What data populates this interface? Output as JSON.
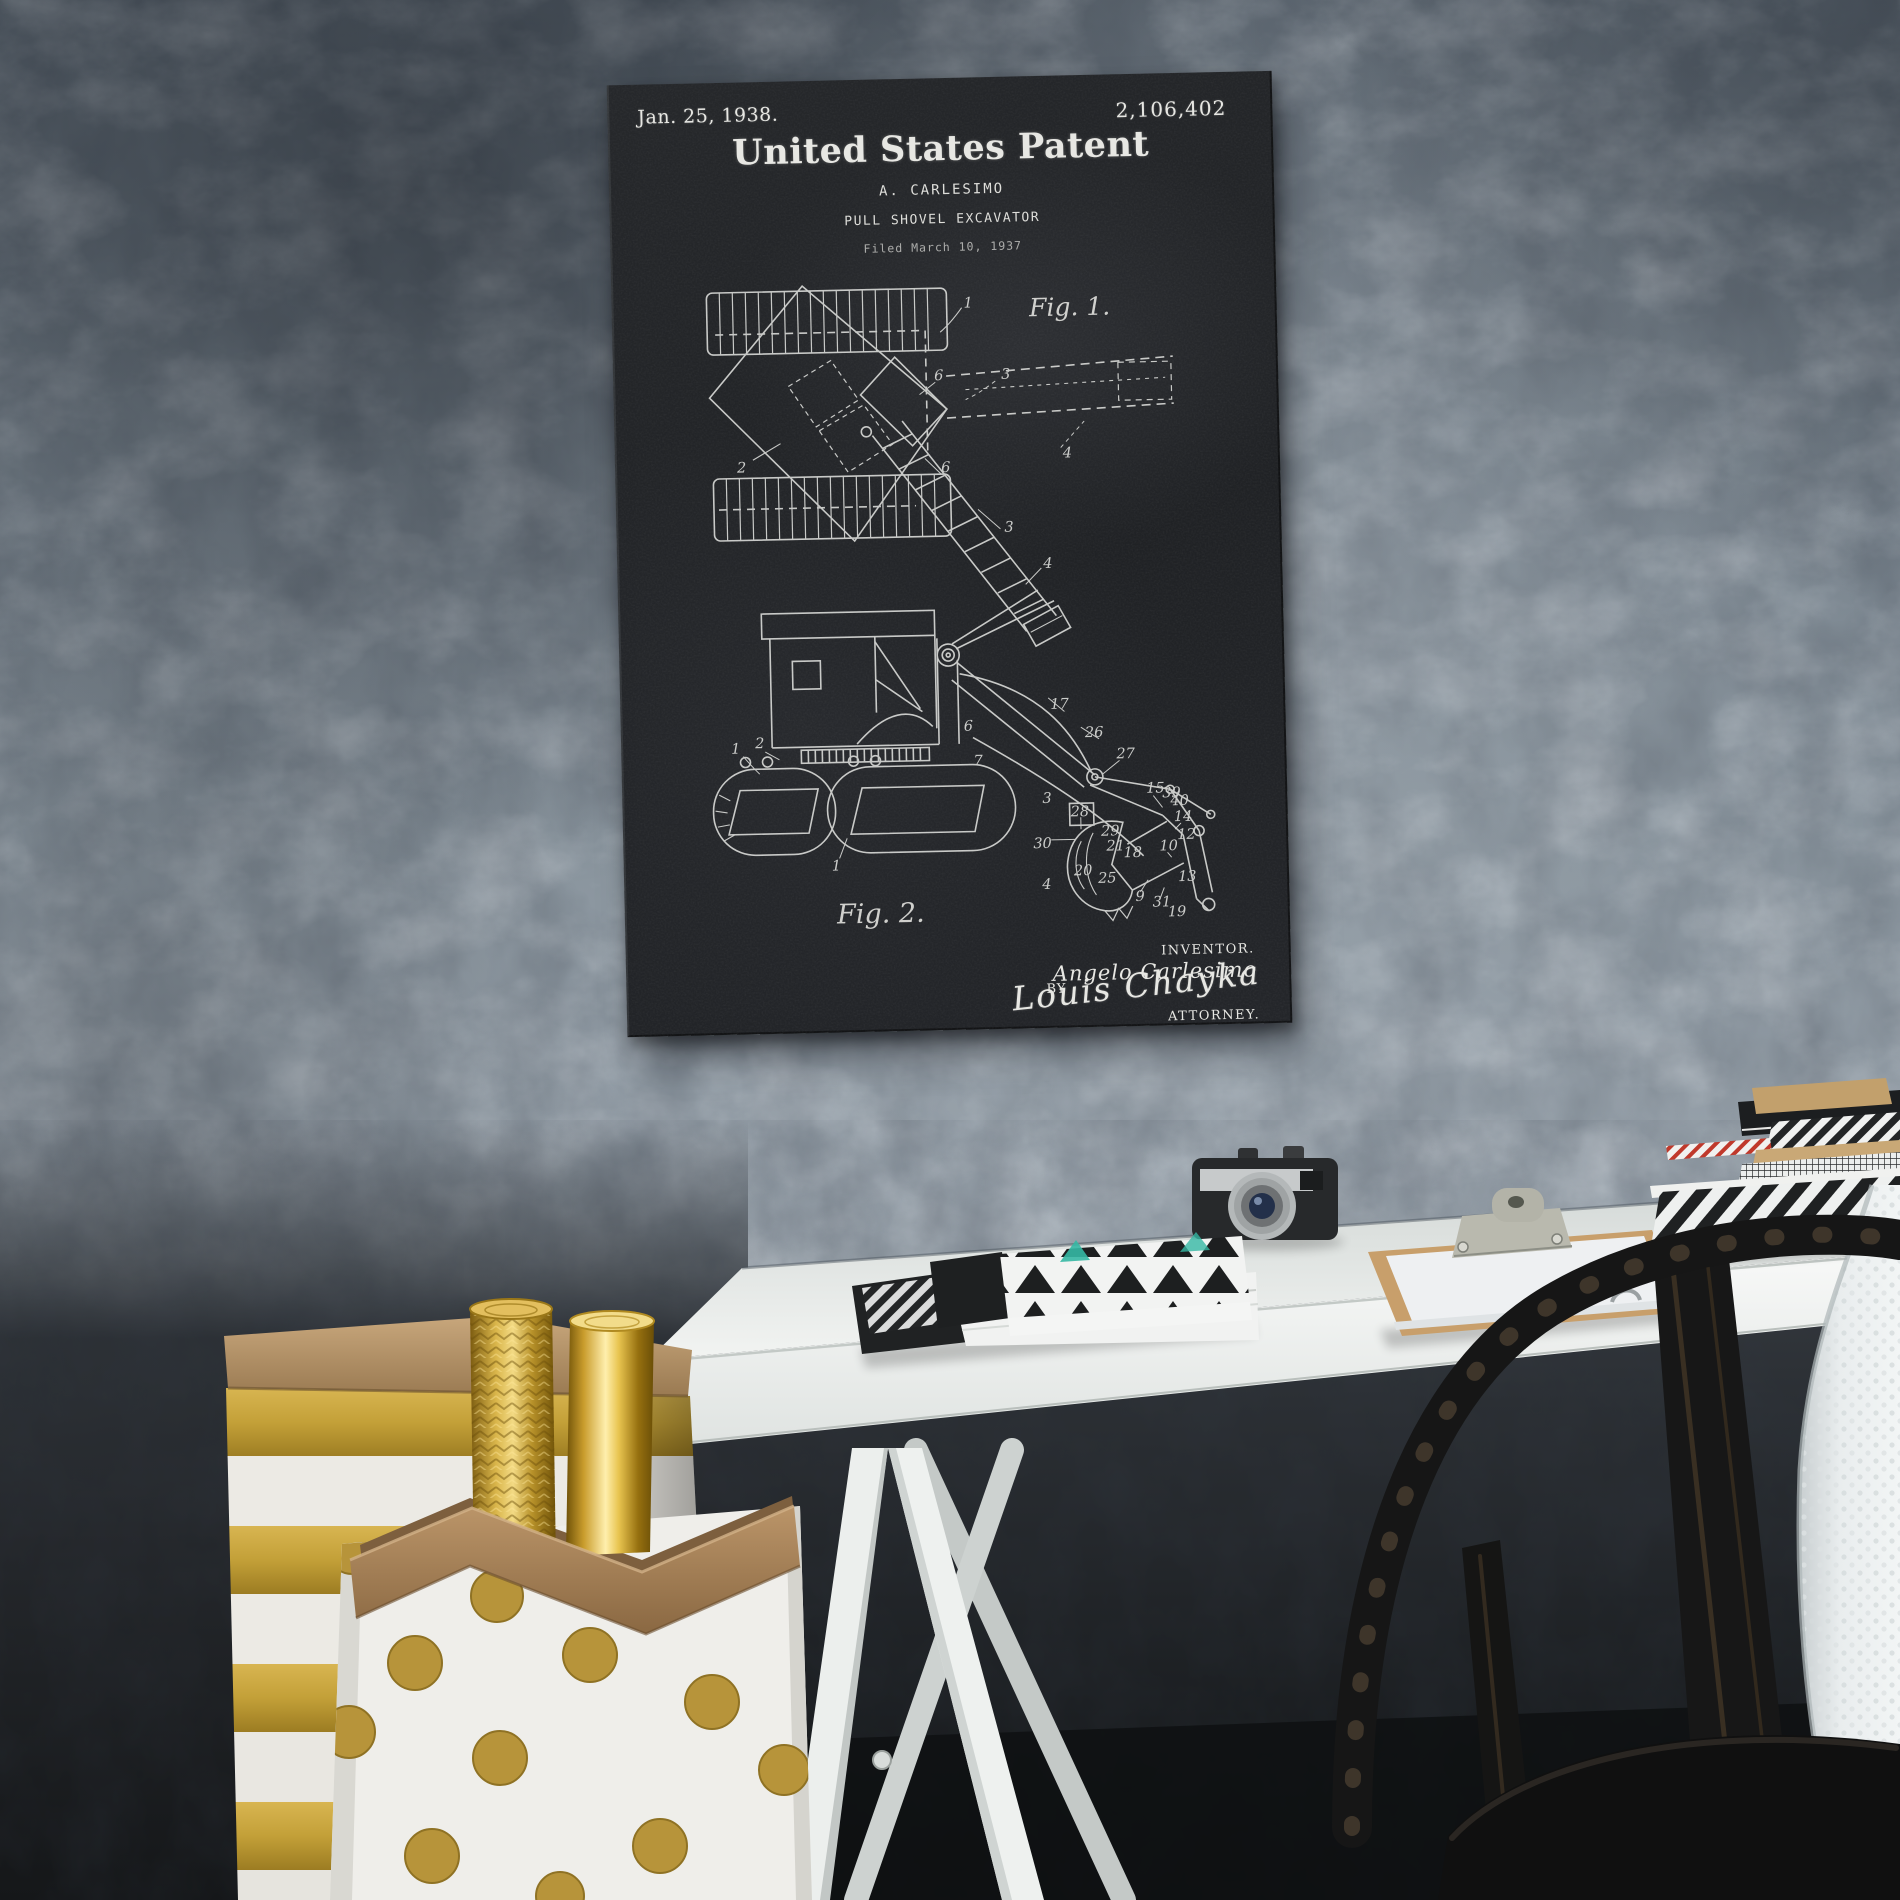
{
  "poster": {
    "date": "Jan. 25, 1938.",
    "patent_number": "2,106,402",
    "title": "United States Patent",
    "author": "A. CARLESIMO",
    "subject": "PULL SHOVEL EXCAVATOR",
    "filed": "Filed March 10, 1937",
    "fig1_caption": "Fig. 1.",
    "fig2_caption": "Fig. 2.",
    "inventor_caption": "INVENTOR.",
    "inventor_name": "Angelo Carlesimo",
    "by_label": "BY",
    "attorney_signature": "Louis Chayka",
    "attorney_caption": "ATTORNEY.",
    "fig1_labels": [
      "1",
      "2",
      "6",
      "3",
      "4",
      "6",
      "3",
      "4"
    ],
    "fig2_labels": [
      "1",
      "2",
      "6",
      "7",
      "17",
      "26",
      "27",
      "3",
      "28",
      "30",
      "29",
      "21",
      "20",
      "18",
      "25",
      "4",
      "15",
      "39",
      "40",
      "14",
      "12",
      "10",
      "13",
      "9",
      "31",
      "19",
      "1"
    ],
    "colors": {
      "board": "#232528",
      "chalk": "#e7e7e3"
    }
  },
  "scene": {
    "colors": {
      "wall": "#86919b",
      "wall_dark": "#23262b",
      "desk": "#eff1ef",
      "gold": "#c2a040",
      "chair": "#181817",
      "kraft": "#b7916a"
    }
  }
}
